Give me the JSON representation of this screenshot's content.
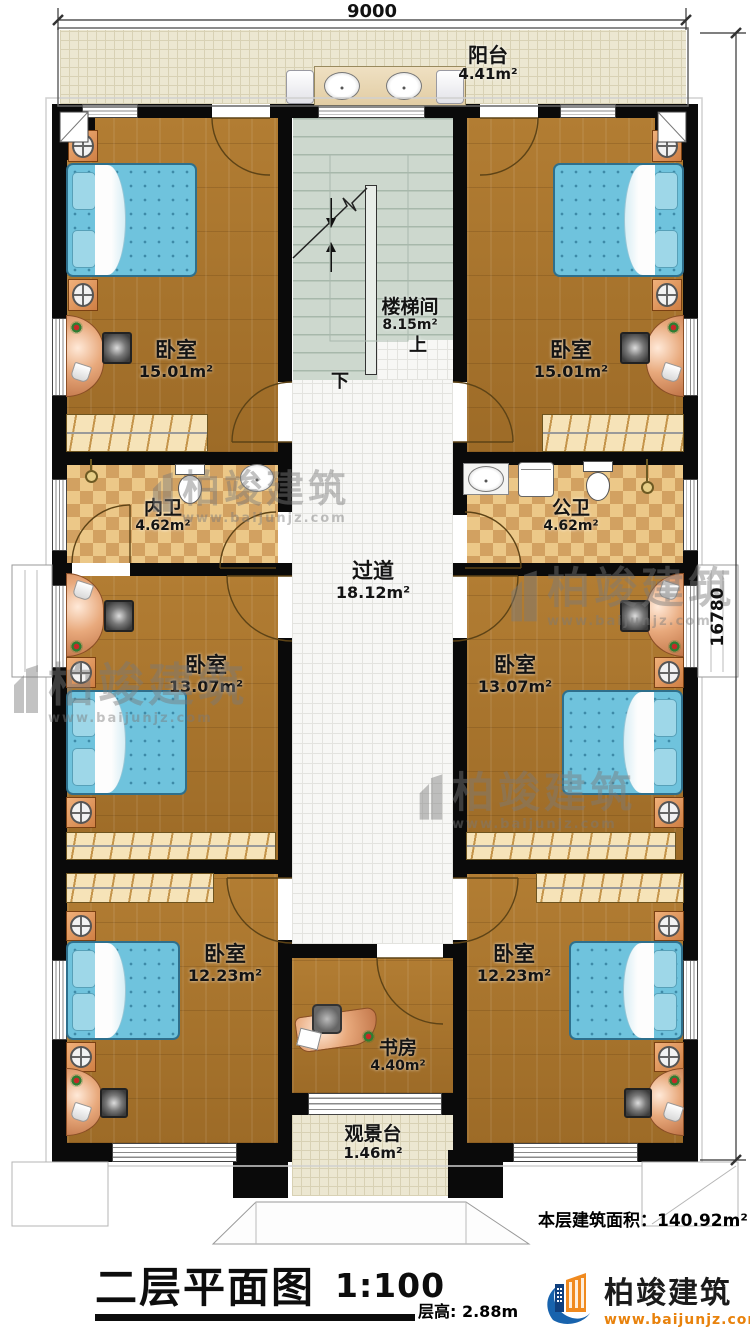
{
  "dimensions": {
    "top": "9000",
    "right": "16780"
  },
  "rooms": {
    "balcony": {
      "name": "阳台",
      "area": "4.41m²"
    },
    "stairwell": {
      "name": "楼梯间",
      "area": "8.15m²",
      "up_label": "上",
      "down_label": "下"
    },
    "bedroom_top_left": {
      "name": "卧室",
      "area": "15.01m²"
    },
    "bedroom_top_right": {
      "name": "卧室",
      "area": "15.01m²"
    },
    "bath_inner": {
      "name": "内卫",
      "area": "4.62m²"
    },
    "bath_public": {
      "name": "公卫",
      "area": "4.62m²"
    },
    "corridor": {
      "name": "过道",
      "area": "18.12m²"
    },
    "bedroom_mid_left": {
      "name": "卧室",
      "area": "13.07m²"
    },
    "bedroom_mid_right": {
      "name": "卧室",
      "area": "13.07m²"
    },
    "bedroom_bottom_left": {
      "name": "卧室",
      "area": "12.23m²"
    },
    "bedroom_bottom_right": {
      "name": "卧室",
      "area": "12.23m²"
    },
    "study": {
      "name": "书房",
      "area": "4.40m²"
    },
    "view_deck": {
      "name": "观景台",
      "area": "1.46m²"
    }
  },
  "title_block": {
    "floor_area_label": "本层建筑面积：",
    "floor_area_value": "140.92m²",
    "title": "二层平面图",
    "scale": "1:100",
    "floor_height": "层高: 2.88m"
  },
  "branding": {
    "watermark_brand": "柏竣建筑",
    "watermark_url": "www.baijunjz.com",
    "logo_brand": "柏竣建筑",
    "logo_url": "www.baijunjz.com"
  },
  "colors": {
    "wood_floor": "#a9742c",
    "bed_blue": "#6fc3dd",
    "bath_tile": "#ecc888",
    "stair_floor": "#cdd8ce",
    "logo_orange": "#f08a1f",
    "logo_blue": "#1863ad",
    "wall_black": "#0a0a0a"
  }
}
